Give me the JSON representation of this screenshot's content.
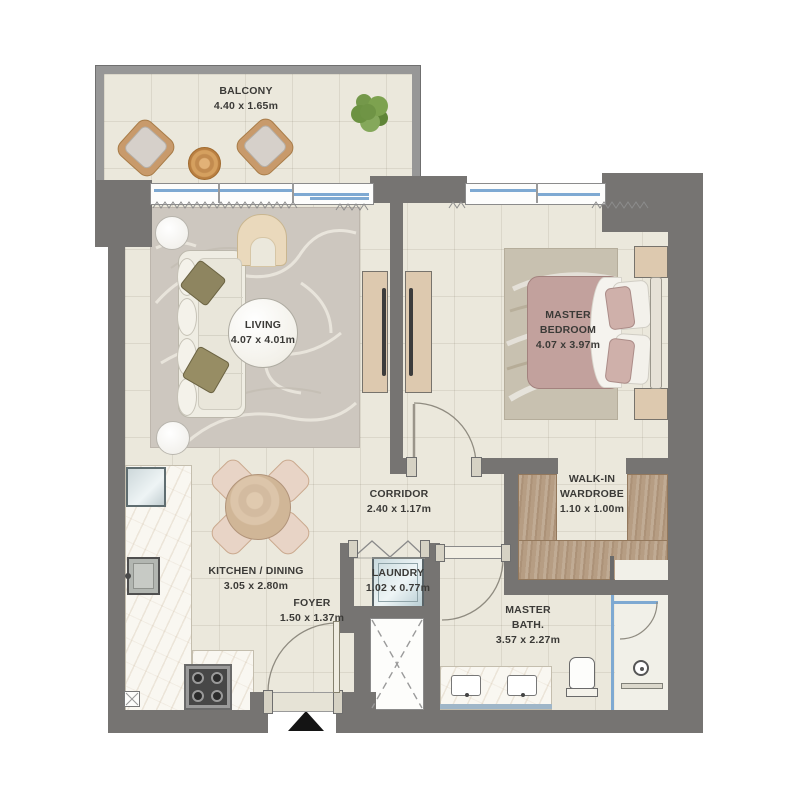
{
  "rooms": {
    "balcony": {
      "name": "BALCONY",
      "dims": "4.40 x 1.65m"
    },
    "living": {
      "name": "LIVING",
      "dims": "4.07 x 4.01m"
    },
    "master_bedroom": {
      "line1": "MASTER",
      "line2": "BEDROOM",
      "dims": "4.07 x 3.97m"
    },
    "corridor": {
      "name": "CORRIDOR",
      "dims": "2.40 x 1.17m"
    },
    "walk_in_wardrobe": {
      "line1": "WALK-IN",
      "line2": "WARDROBE",
      "dims": "1.10 x 1.00m"
    },
    "kitchen_dining": {
      "name": "KITCHEN / DINING",
      "dims": "3.05 x 2.80m"
    },
    "laundry": {
      "name": "LAUNDRY",
      "dims": "1.02 x 0.77m"
    },
    "foyer": {
      "name": "FOYER",
      "dims": "1.50 x 1.37m"
    },
    "master_bath": {
      "line1": "MASTER",
      "line2": "BATH.",
      "dims": "3.57 x 2.27m"
    }
  },
  "palette": {
    "wall": "#767472",
    "floor": "#ebe8dc",
    "balcony_wall": "#979797",
    "wardrobe_wood": "#b69d83",
    "cabinet_wood": "#ddc9af",
    "window_glass": "#7ea9d2",
    "bed_linen": "#c2a19d",
    "rug": "#cdc7bf",
    "sofa_pillow_olive": "#8e8560",
    "entrance_arrow": "#141414"
  }
}
